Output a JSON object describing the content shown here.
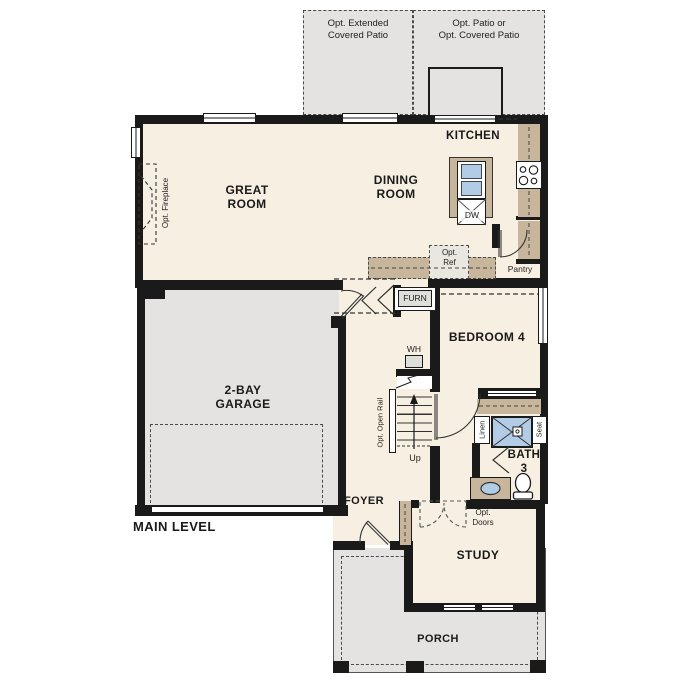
{
  "labels": {
    "main_level": "MAIN LEVEL",
    "great_room": "GREAT\nROOM",
    "dining_room": "DINING\nROOM",
    "kitchen": "KITCHEN",
    "garage": "2-BAY\nGARAGE",
    "bedroom4": "BEDROOM 4",
    "bath3": "BATH\n3",
    "study": "STUDY",
    "foyer": "FOYER",
    "porch": "PORCH",
    "pantry": "Pantry",
    "furn": "FURN",
    "wh": "WH",
    "up": "Up",
    "dw": "DW",
    "linen": "Linen",
    "seat": "Seat",
    "opt_ref": "Opt.\nRef",
    "opt_doors": "Opt.\nDoors",
    "opt_fireplace": "Opt. Fireplace",
    "opt_open_rail": "Opt. Open Rail",
    "opt_extended_patio": "Opt. Extended\nCovered Patio",
    "opt_patio": "Opt. Patio or\nOpt. Covered Patio"
  },
  "colors": {
    "floor": "#f7f0e2",
    "concrete": "#e4e3e1",
    "counter": "#c7b69c",
    "water": "#b3cce6",
    "wall": "#1a1a1a"
  }
}
